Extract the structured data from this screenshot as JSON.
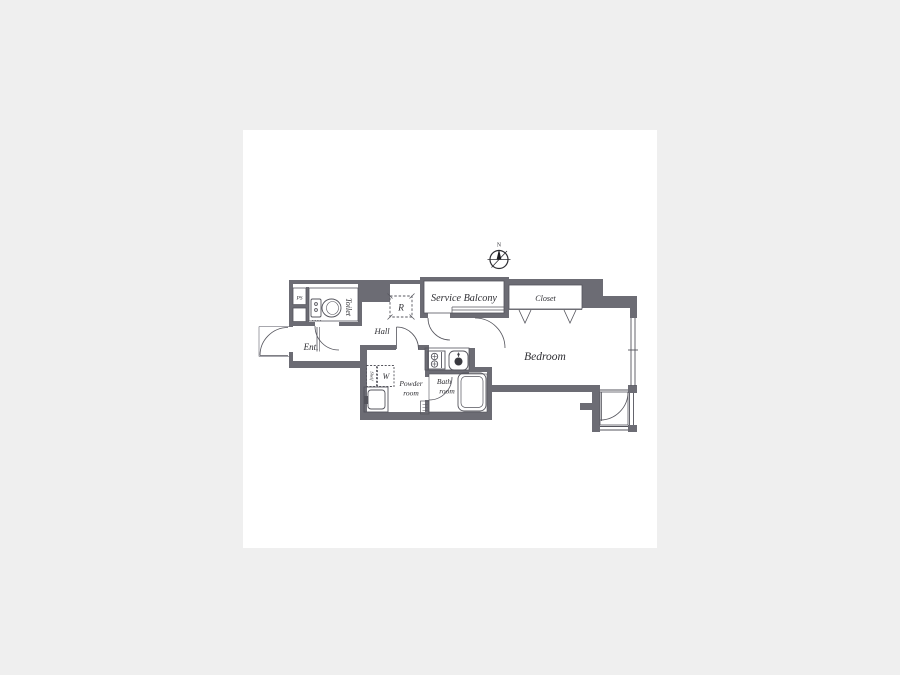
{
  "page": {
    "background": "#efefef",
    "card_background": "#ffffff"
  },
  "colors": {
    "wall": "#6c6c74",
    "line": "#54545c",
    "text": "#2e2e33"
  },
  "compass": {
    "north": "N"
  },
  "rooms": {
    "service_balcony": "Service Balcony",
    "closet": "Closet",
    "bedroom": "Bedroom",
    "hall": "Hall",
    "entrance": "Ent.",
    "toilet": "Toilet",
    "powder_line1": "Powder",
    "powder_line2": "room",
    "bath_line1": "Bath",
    "bath_line2": "room"
  },
  "fixtures": {
    "refrigerator": "R",
    "washer": "W",
    "pipe_space": "PS",
    "shelf": "Shelf"
  }
}
